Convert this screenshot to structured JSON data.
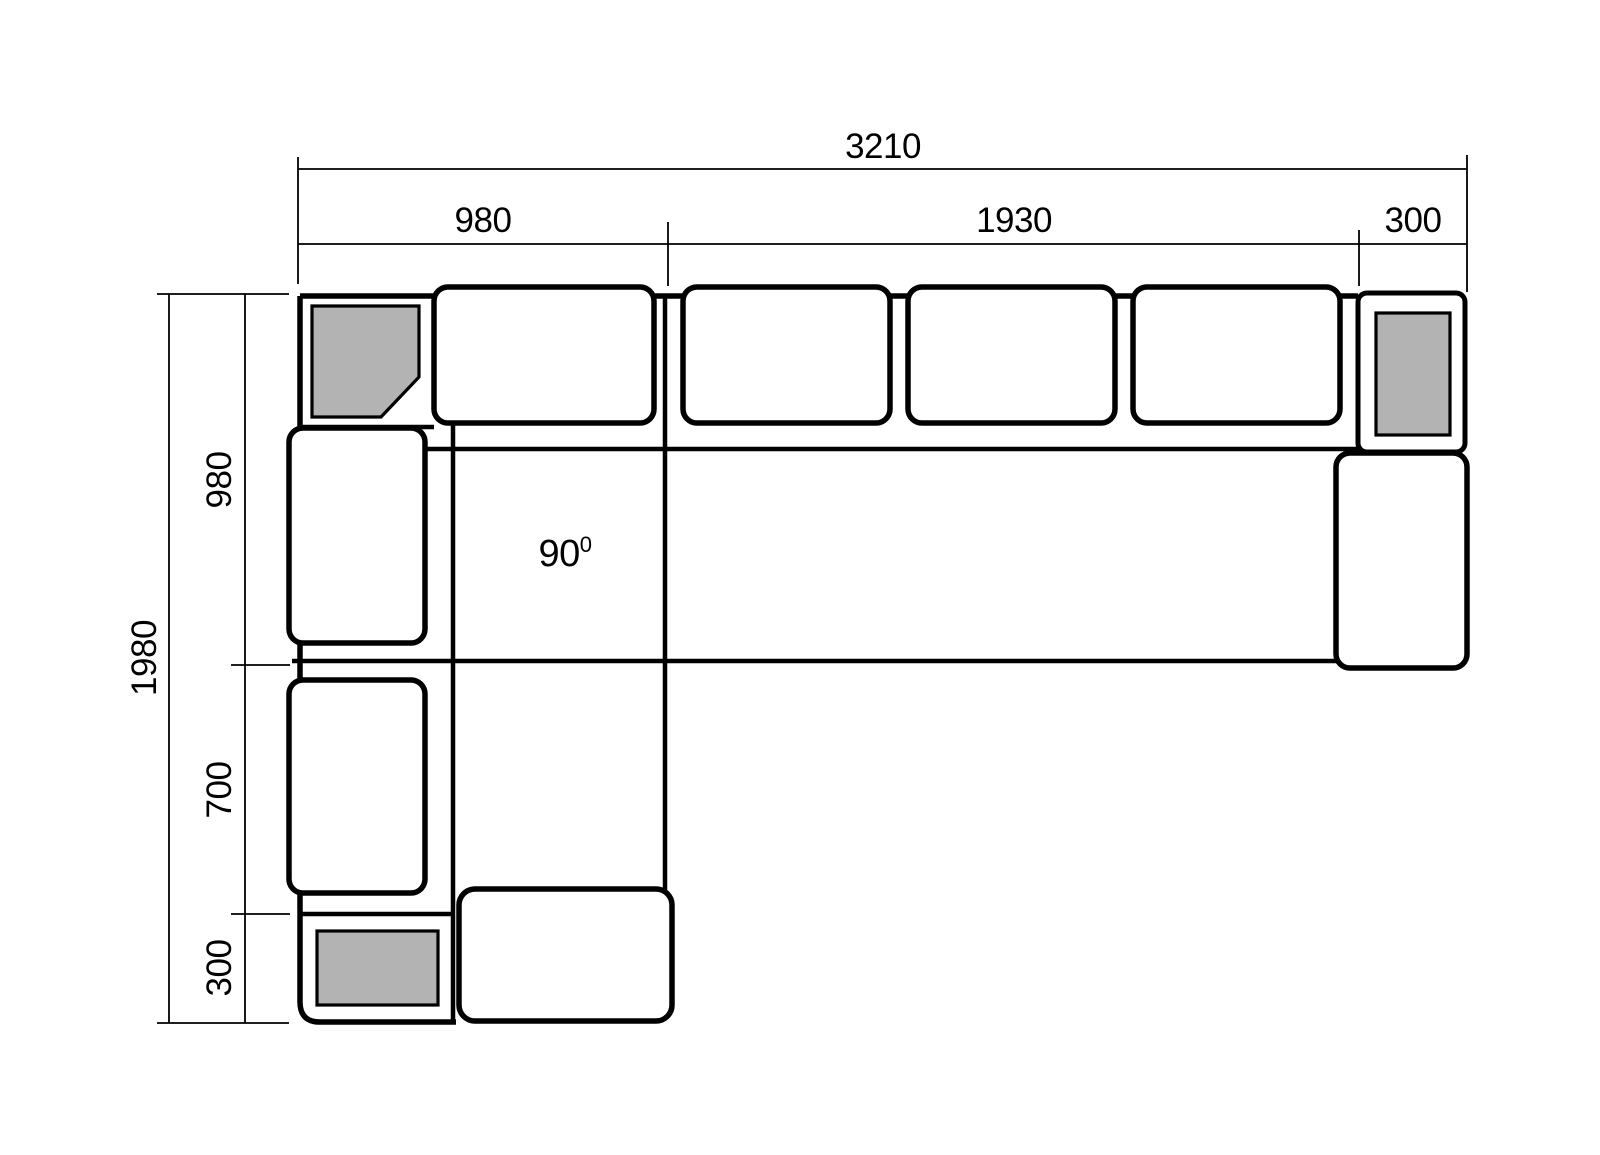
{
  "figure": {
    "description": "Corner sofa top-view dimension drawing",
    "horizontal_dimension": {
      "total": "3210",
      "segments": [
        "980",
        "1930",
        "300"
      ]
    },
    "vertical_dimension": {
      "total": "1980",
      "segments": [
        "980",
        "700",
        "300"
      ]
    },
    "angle": {
      "value": "90",
      "superscript": "0"
    },
    "colors": {
      "stroke": "#000000",
      "cushion_fill": "#ffffff",
      "armrest_fill": "#b3b3b3",
      "background": "#ffffff"
    }
  }
}
